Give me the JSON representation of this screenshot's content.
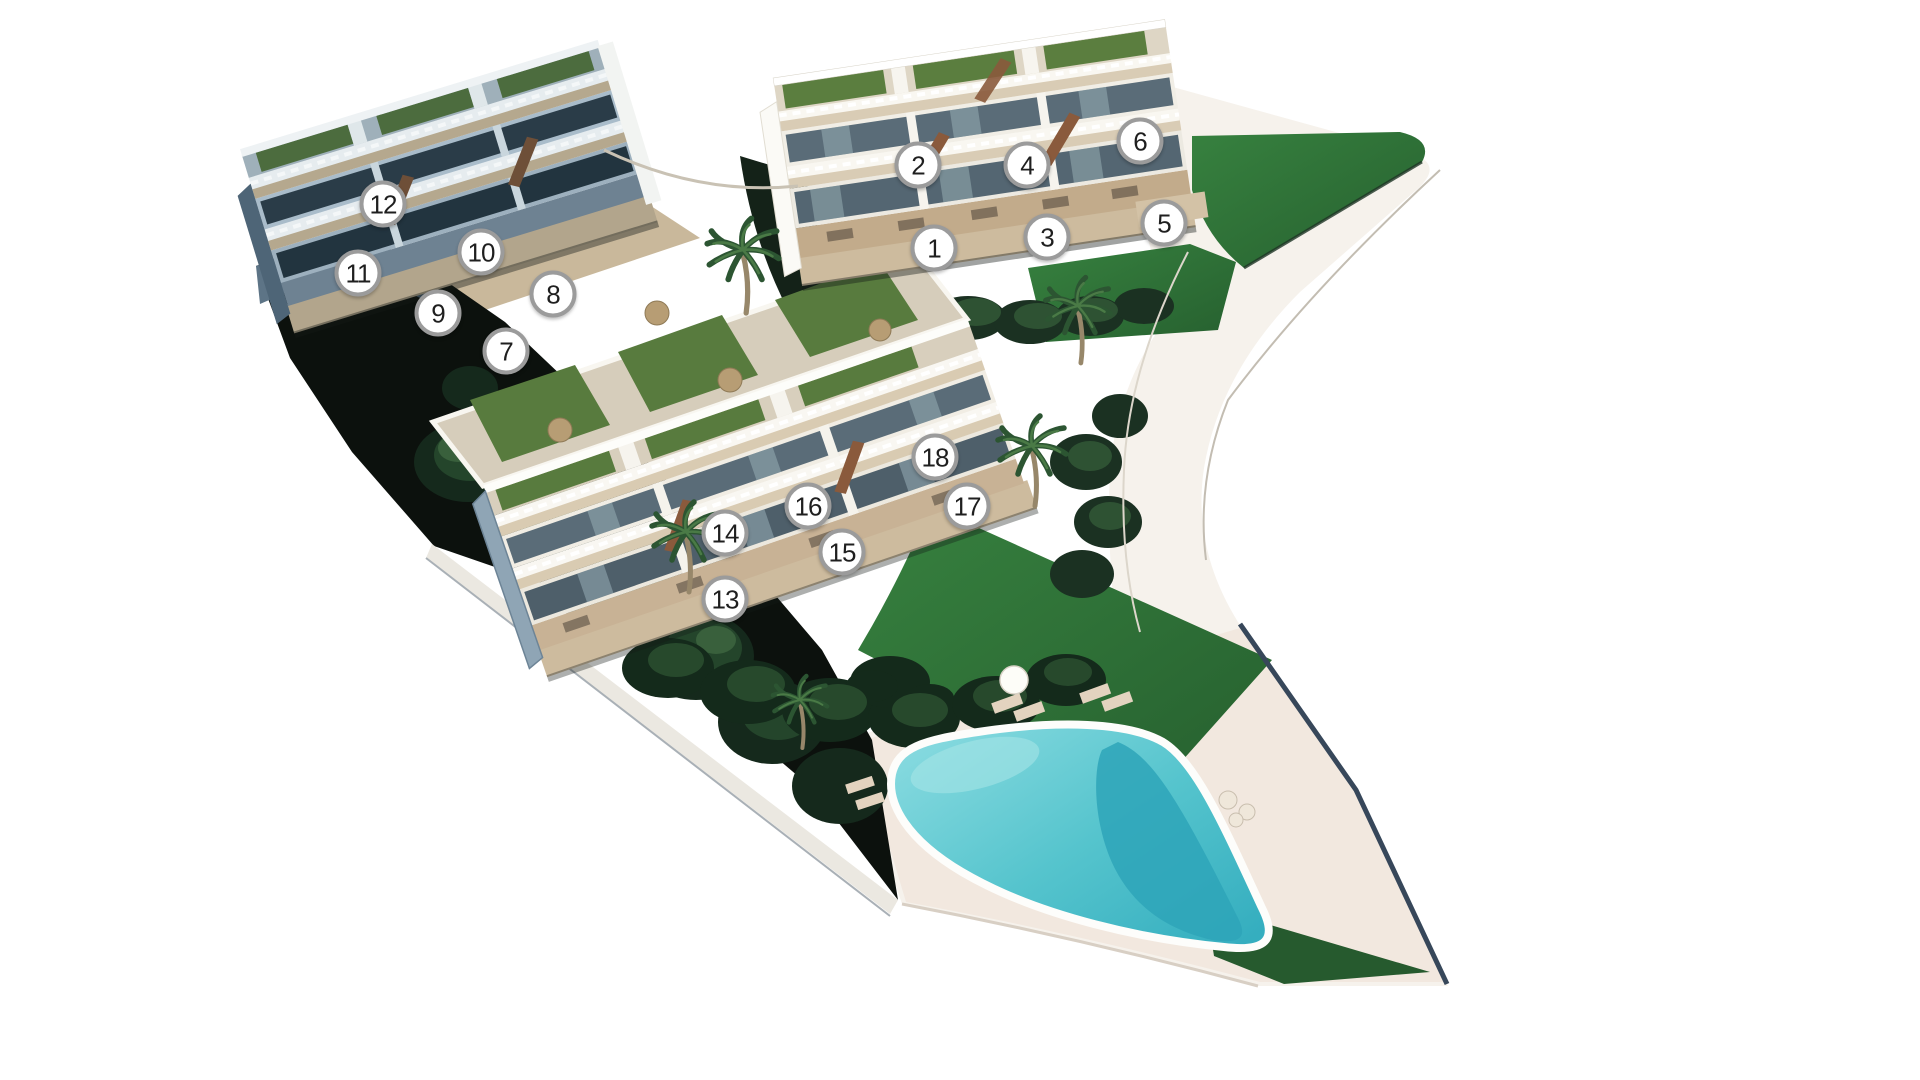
{
  "page": {
    "background": "#ffffff",
    "width": 1920,
    "height": 1080,
    "description": "Aerial 3D site plan render of a hillside residential development with numbered apartment units, gardens, pathways and a communal swimming pool"
  },
  "site_plan": {
    "unit_count": 18,
    "blocks": [
      {
        "name": "block-north",
        "unit_labels": [
          "1",
          "2",
          "3",
          "4",
          "5",
          "6"
        ]
      },
      {
        "name": "block-west",
        "unit_labels": [
          "7",
          "8",
          "9",
          "10",
          "11",
          "12"
        ]
      },
      {
        "name": "block-south",
        "unit_labels": [
          "13",
          "14",
          "15",
          "16",
          "17",
          "18"
        ]
      }
    ],
    "unit_markers": [
      {
        "label": "1",
        "x": 934,
        "y": 248
      },
      {
        "label": "2",
        "x": 918,
        "y": 165
      },
      {
        "label": "3",
        "x": 1047,
        "y": 237
      },
      {
        "label": "4",
        "x": 1027,
        "y": 165
      },
      {
        "label": "5",
        "x": 1164,
        "y": 223
      },
      {
        "label": "6",
        "x": 1140,
        "y": 141
      },
      {
        "label": "7",
        "x": 506,
        "y": 351
      },
      {
        "label": "8",
        "x": 553,
        "y": 294
      },
      {
        "label": "9",
        "x": 438,
        "y": 313
      },
      {
        "label": "10",
        "x": 481,
        "y": 252
      },
      {
        "label": "11",
        "x": 358,
        "y": 273
      },
      {
        "label": "12",
        "x": 383,
        "y": 204
      },
      {
        "label": "13",
        "x": 725,
        "y": 599
      },
      {
        "label": "14",
        "x": 725,
        "y": 533
      },
      {
        "label": "15",
        "x": 842,
        "y": 552
      },
      {
        "label": "16",
        "x": 808,
        "y": 506
      },
      {
        "label": "17",
        "x": 967,
        "y": 506
      },
      {
        "label": "18",
        "x": 935,
        "y": 457
      }
    ],
    "marker_style": {
      "diameter_px": 47,
      "fill": "#ffffff",
      "ring": "#9b9b9b",
      "text_color": "#1f1f1f"
    },
    "features": [
      "swimming-pool",
      "sun-deck",
      "lawns",
      "roof-gardens",
      "palm-trees",
      "hedges",
      "pathways",
      "hillside-retaining-walls"
    ],
    "palette": {
      "background": "#ffffff",
      "path": "#f6f2ec",
      "deck": "#f2e8df",
      "lawn_light": "#37813f",
      "lawn_dark": "#26602f",
      "hedge": "#1b3122",
      "hillside_shadow": "#0c110d",
      "pool_light": "#8edde2",
      "pool_dark": "#2ea4b8",
      "building_warm_wall": "#f1eee6",
      "building_shadow_wall": "#9db0be",
      "terrace_beige": "#d9ccb5",
      "plinth_tan": "#c2ab8b",
      "glass": "#5a6c78",
      "stairs_wood": "#8a5a3c"
    }
  }
}
